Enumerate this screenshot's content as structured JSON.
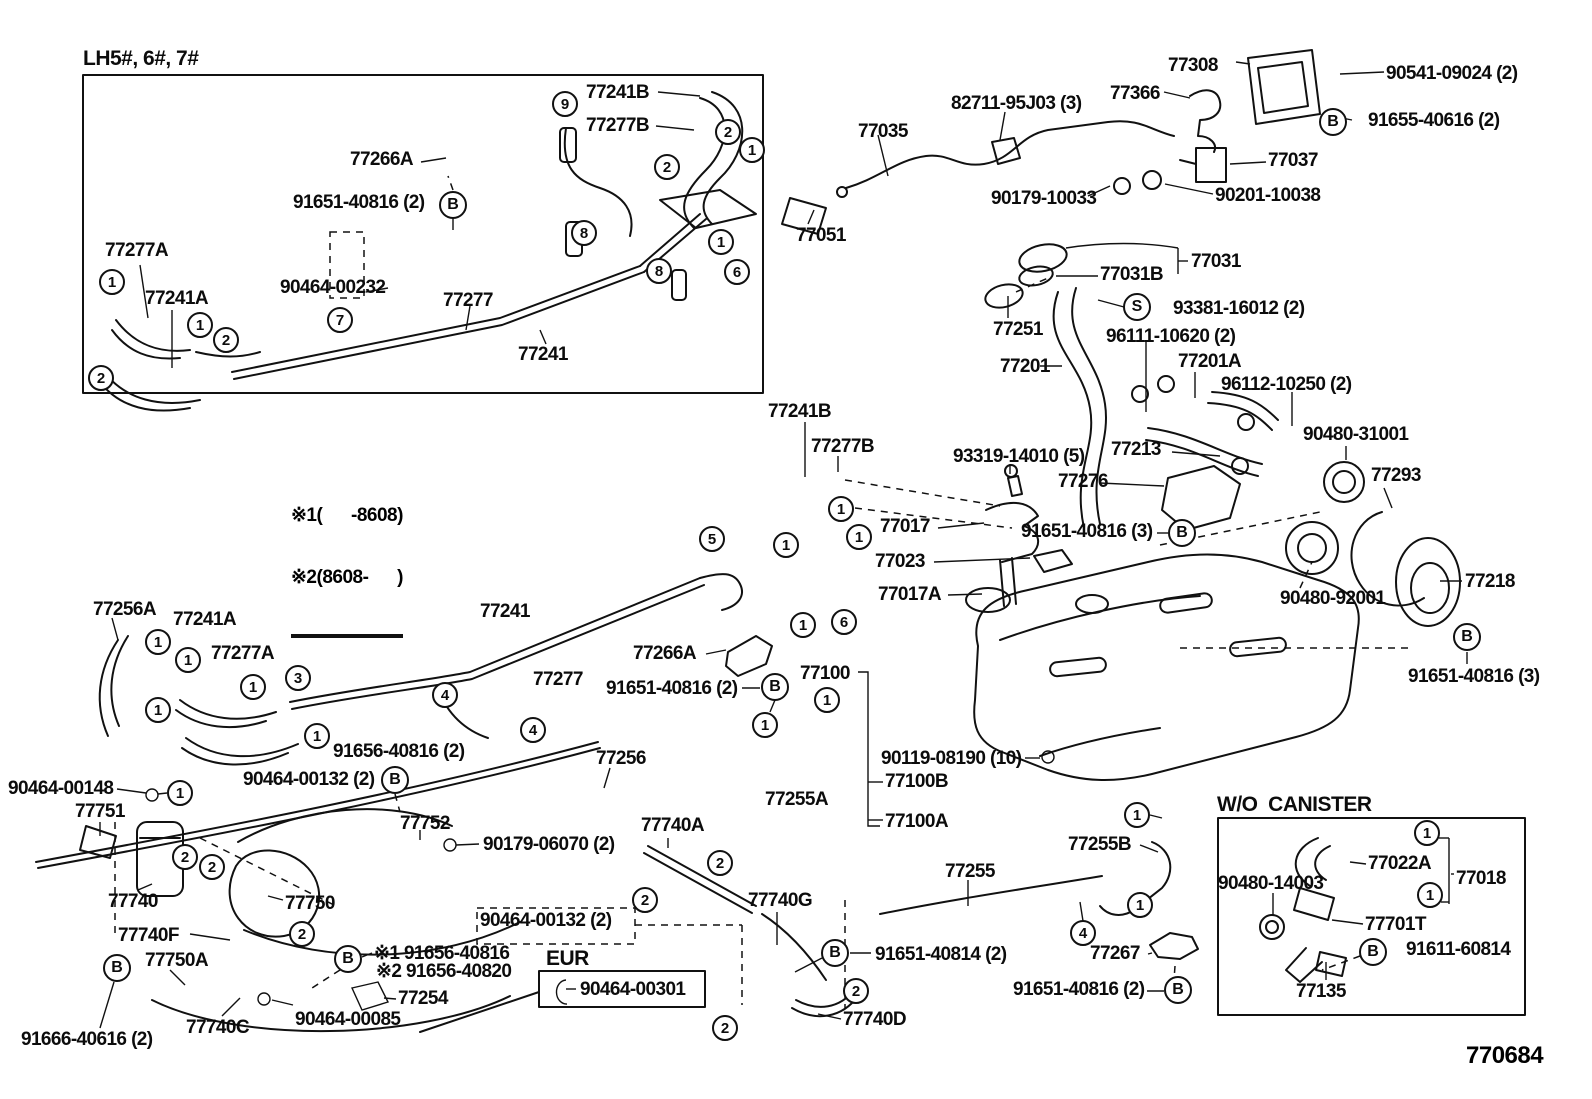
{
  "page": {
    "width": 1592,
    "height": 1099,
    "background": "#ffffff",
    "ink": "#111111"
  },
  "sections": {
    "top_left_box_title": "LH5#, 6#, 7#",
    "wo_canister_title": "W/O  CANISTER",
    "eur_title": "EUR"
  },
  "notes": {
    "line1": "※1(      -8608)",
    "line2": "※2(8608-      )"
  },
  "footer": {
    "diagram_number": "770684"
  },
  "part_labels": [
    {
      "text": "77241B",
      "x": 586,
      "y": 83
    },
    {
      "text": "77277B",
      "x": 586,
      "y": 116
    },
    {
      "text": "77266A",
      "x": 350,
      "y": 150
    },
    {
      "text": "91651-40816 (2)",
      "x": 293,
      "y": 193
    },
    {
      "text": "90464-00232",
      "x": 280,
      "y": 278
    },
    {
      "text": "77277A",
      "x": 105,
      "y": 241
    },
    {
      "text": "77241A",
      "x": 145,
      "y": 289
    },
    {
      "text": "77277",
      "x": 443,
      "y": 291
    },
    {
      "text": "77241",
      "x": 518,
      "y": 345
    },
    {
      "text": "77308",
      "x": 1168,
      "y": 56
    },
    {
      "text": "90541-09024 (2)",
      "x": 1386,
      "y": 64
    },
    {
      "text": "77366",
      "x": 1110,
      "y": 84
    },
    {
      "text": "91655-40616 (2)",
      "x": 1368,
      "y": 111
    },
    {
      "text": "82711-95J03 (3)",
      "x": 951,
      "y": 94
    },
    {
      "text": "77035",
      "x": 858,
      "y": 122
    },
    {
      "text": "77051",
      "x": 796,
      "y": 226
    },
    {
      "text": "90179-10033",
      "x": 991,
      "y": 189
    },
    {
      "text": "90201-10038",
      "x": 1215,
      "y": 186
    },
    {
      "text": "77037",
      "x": 1268,
      "y": 151
    },
    {
      "text": "77031",
      "x": 1191,
      "y": 252
    },
    {
      "text": "77031B",
      "x": 1100,
      "y": 265
    },
    {
      "text": "93381-16012 (2)",
      "x": 1173,
      "y": 299
    },
    {
      "text": "77251",
      "x": 993,
      "y": 320
    },
    {
      "text": "96111-10620 (2)",
      "x": 1106,
      "y": 327
    },
    {
      "text": "77201",
      "x": 1000,
      "y": 357
    },
    {
      "text": "77201A",
      "x": 1178,
      "y": 352
    },
    {
      "text": "96112-10250 (2)",
      "x": 1221,
      "y": 375
    },
    {
      "text": "77213",
      "x": 1111,
      "y": 440
    },
    {
      "text": "90480-31001",
      "x": 1303,
      "y": 425
    },
    {
      "text": "77293",
      "x": 1371,
      "y": 466
    },
    {
      "text": "77218",
      "x": 1465,
      "y": 572
    },
    {
      "text": "90480-92001",
      "x": 1280,
      "y": 589
    },
    {
      "text": "91651-40816 (3)",
      "x": 1408,
      "y": 667
    },
    {
      "text": "77241B",
      "x": 768,
      "y": 402
    },
    {
      "text": "77277B",
      "x": 811,
      "y": 437
    },
    {
      "text": "93319-14010 (5)",
      "x": 953,
      "y": 447
    },
    {
      "text": "77276",
      "x": 1058,
      "y": 472
    },
    {
      "text": "77017",
      "x": 880,
      "y": 517
    },
    {
      "text": "91651-40816 (3)",
      "x": 1021,
      "y": 522
    },
    {
      "text": "77023",
      "x": 875,
      "y": 552
    },
    {
      "text": "77017A",
      "x": 878,
      "y": 585
    },
    {
      "text": "77100",
      "x": 800,
      "y": 664
    },
    {
      "text": "77256A",
      "x": 93,
      "y": 600
    },
    {
      "text": "77241A",
      "x": 173,
      "y": 610
    },
    {
      "text": "77277A",
      "x": 211,
      "y": 644
    },
    {
      "text": "77241",
      "x": 480,
      "y": 602
    },
    {
      "text": "77277",
      "x": 533,
      "y": 670
    },
    {
      "text": "77266A",
      "x": 633,
      "y": 644
    },
    {
      "text": "91651-40816 (2)",
      "x": 606,
      "y": 679
    },
    {
      "text": "77256",
      "x": 596,
      "y": 749
    },
    {
      "text": "77255A",
      "x": 765,
      "y": 790
    },
    {
      "text": "90119-08190 (10)",
      "x": 881,
      "y": 749
    },
    {
      "text": "77100B",
      "x": 885,
      "y": 772
    },
    {
      "text": "77100A",
      "x": 885,
      "y": 812
    },
    {
      "text": "77255B",
      "x": 1068,
      "y": 835
    },
    {
      "text": "77255",
      "x": 945,
      "y": 862
    },
    {
      "text": "90464-00148",
      "x": 8,
      "y": 779
    },
    {
      "text": "77751",
      "x": 75,
      "y": 802
    },
    {
      "text": "91656-40816 (2)",
      "x": 333,
      "y": 742
    },
    {
      "text": "90464-00132 (2)",
      "x": 243,
      "y": 770
    },
    {
      "text": "77752",
      "x": 400,
      "y": 814
    },
    {
      "text": "90179-06070 (2)",
      "x": 483,
      "y": 835
    },
    {
      "text": "77740",
      "x": 108,
      "y": 892
    },
    {
      "text": "77750",
      "x": 285,
      "y": 894
    },
    {
      "text": "77740F",
      "x": 118,
      "y": 926
    },
    {
      "text": "77750A",
      "x": 145,
      "y": 951
    },
    {
      "text": "91666-40616 (2)",
      "x": 21,
      "y": 1030
    },
    {
      "text": "77740C",
      "x": 186,
      "y": 1018
    },
    {
      "text": "90464-00085",
      "x": 295,
      "y": 1010
    },
    {
      "text": "77254",
      "x": 398,
      "y": 989
    },
    {
      "text": "※1 91656-40816",
      "x": 374,
      "y": 944
    },
    {
      "text": "※2 91656-40820",
      "x": 376,
      "y": 962
    },
    {
      "text": "90464-00132 (2)",
      "x": 480,
      "y": 911
    },
    {
      "text": "90464-00301",
      "x": 580,
      "y": 980
    },
    {
      "text": "77740A",
      "x": 641,
      "y": 816
    },
    {
      "text": "77740G",
      "x": 748,
      "y": 891
    },
    {
      "text": "77740D",
      "x": 843,
      "y": 1010
    },
    {
      "text": "91651-40814 (2)",
      "x": 875,
      "y": 945
    },
    {
      "text": "77267",
      "x": 1090,
      "y": 944
    },
    {
      "text": "91651-40816 (2)",
      "x": 1013,
      "y": 980
    },
    {
      "text": "90480-14003",
      "x": 1218,
      "y": 874
    },
    {
      "text": "77022A",
      "x": 1368,
      "y": 854
    },
    {
      "text": "77018",
      "x": 1456,
      "y": 869
    },
    {
      "text": "77701T",
      "x": 1365,
      "y": 915
    },
    {
      "text": "91611-60814",
      "x": 1406,
      "y": 940
    },
    {
      "text": "77135",
      "x": 1296,
      "y": 982
    }
  ],
  "callout_numbers": [
    {
      "n": "9",
      "x": 565,
      "y": 104
    },
    {
      "n": "2",
      "x": 728,
      "y": 132
    },
    {
      "n": "1",
      "x": 752,
      "y": 150
    },
    {
      "n": "2",
      "x": 667,
      "y": 167
    },
    {
      "n": "8",
      "x": 584,
      "y": 233
    },
    {
      "n": "1",
      "x": 721,
      "y": 242
    },
    {
      "n": "8",
      "x": 659,
      "y": 271
    },
    {
      "n": "6",
      "x": 737,
      "y": 272
    },
    {
      "n": "7",
      "x": 340,
      "y": 320
    },
    {
      "n": "1",
      "x": 112,
      "y": 282
    },
    {
      "n": "1",
      "x": 200,
      "y": 325
    },
    {
      "n": "2",
      "x": 226,
      "y": 340
    },
    {
      "n": "2",
      "x": 101,
      "y": 378
    },
    {
      "n": "5",
      "x": 712,
      "y": 539
    },
    {
      "n": "1",
      "x": 786,
      "y": 545
    },
    {
      "n": "1",
      "x": 841,
      "y": 509
    },
    {
      "n": "1",
      "x": 859,
      "y": 537
    },
    {
      "n": "1",
      "x": 803,
      "y": 625
    },
    {
      "n": "6",
      "x": 844,
      "y": 622
    },
    {
      "n": "1",
      "x": 827,
      "y": 700
    },
    {
      "n": "1",
      "x": 765,
      "y": 725
    },
    {
      "n": "3",
      "x": 298,
      "y": 678
    },
    {
      "n": "1",
      "x": 158,
      "y": 642
    },
    {
      "n": "1",
      "x": 188,
      "y": 660
    },
    {
      "n": "1",
      "x": 253,
      "y": 687
    },
    {
      "n": "1",
      "x": 158,
      "y": 710
    },
    {
      "n": "1",
      "x": 317,
      "y": 736
    },
    {
      "n": "4",
      "x": 445,
      "y": 695
    },
    {
      "n": "4",
      "x": 533,
      "y": 730
    },
    {
      "n": "1",
      "x": 180,
      "y": 793
    },
    {
      "n": "2",
      "x": 185,
      "y": 857
    },
    {
      "n": "2",
      "x": 212,
      "y": 867
    },
    {
      "n": "2",
      "x": 302,
      "y": 934
    },
    {
      "n": "2",
      "x": 720,
      "y": 863
    },
    {
      "n": "2",
      "x": 645,
      "y": 900
    },
    {
      "n": "2",
      "x": 725,
      "y": 1028
    },
    {
      "n": "2",
      "x": 856,
      "y": 991
    },
    {
      "n": "1",
      "x": 1137,
      "y": 815
    },
    {
      "n": "1",
      "x": 1140,
      "y": 905
    },
    {
      "n": "4",
      "x": 1083,
      "y": 933
    },
    {
      "n": "1",
      "x": 1427,
      "y": 833
    },
    {
      "n": "1",
      "x": 1430,
      "y": 895
    }
  ],
  "callout_letters": [
    {
      "ch": "B",
      "x": 453,
      "y": 205
    },
    {
      "ch": "B",
      "x": 1333,
      "y": 122
    },
    {
      "ch": "S",
      "x": 1137,
      "y": 307
    },
    {
      "ch": "B",
      "x": 1182,
      "y": 533
    },
    {
      "ch": "B",
      "x": 1467,
      "y": 637
    },
    {
      "ch": "B",
      "x": 775,
      "y": 687
    },
    {
      "ch": "B",
      "x": 395,
      "y": 780
    },
    {
      "ch": "B",
      "x": 348,
      "y": 959
    },
    {
      "ch": "B",
      "x": 117,
      "y": 968
    },
    {
      "ch": "B",
      "x": 835,
      "y": 953
    },
    {
      "ch": "B",
      "x": 1178,
      "y": 990
    },
    {
      "ch": "B",
      "x": 1373,
      "y": 952
    }
  ]
}
